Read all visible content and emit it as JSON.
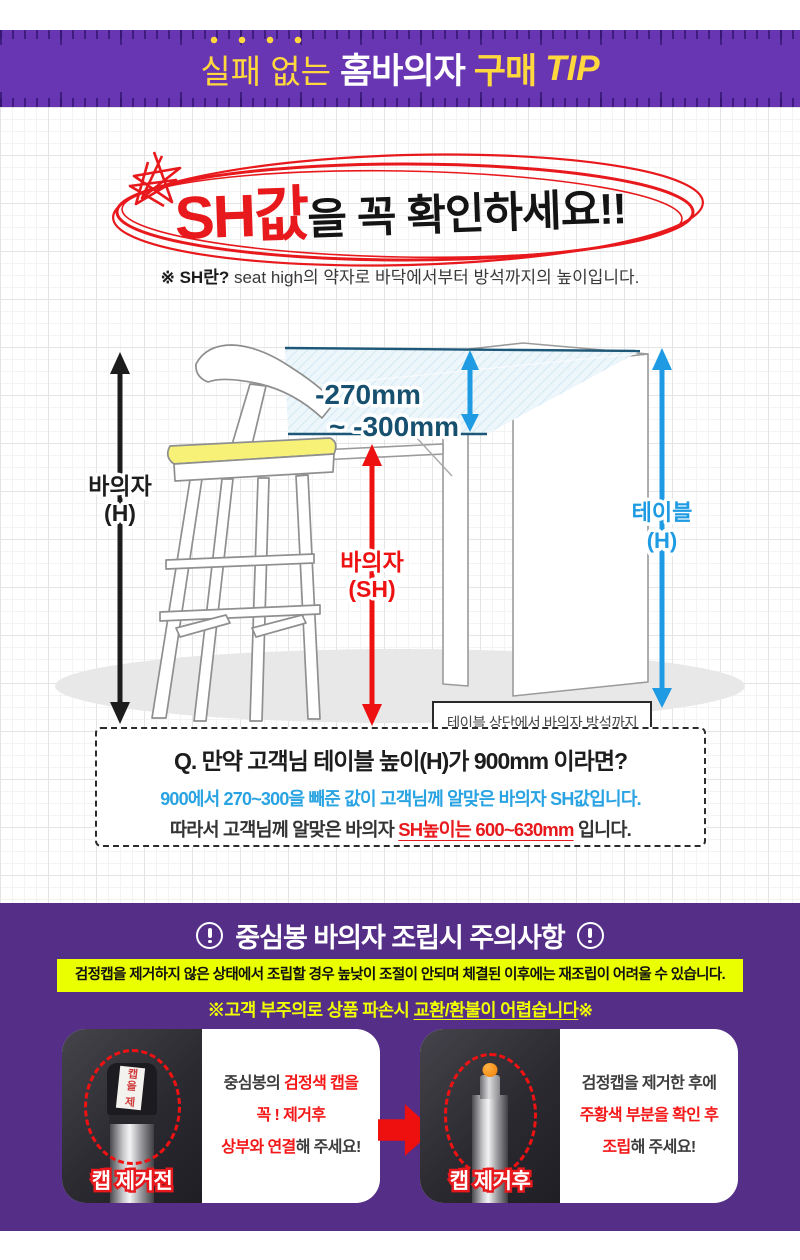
{
  "colors": {
    "purple_band": "#6836b3",
    "purple_section": "#552e87",
    "accent_red": "#e8191c",
    "accent_blue": "#29a0e2",
    "range_navy": "#17506f",
    "title_yellow": "#ffd83d",
    "highlight_yellow": "#eaff00",
    "cushion_yellow": "#f7f277"
  },
  "header": {
    "title": {
      "part1": "실패 없는",
      "part2": "홈바의자",
      "part3": "구매",
      "part4": "TIP"
    }
  },
  "hero": {
    "headline": {
      "highlight": "SH값",
      "rest": "을 꼭 확인하세요!!"
    },
    "definition": {
      "prefix": "※ SH란?",
      "rest": " seat high의 약자로 바닥에서부터 방석까지의 높이입니다."
    }
  },
  "diagram": {
    "range_line1": "-270mm",
    "range_line2": "~ -300mm",
    "chair_h": {
      "line1": "바의자",
      "line2": "(H)"
    },
    "chair_sh": {
      "line1": "바의자",
      "line2": "(SH)"
    },
    "table_h": {
      "line1": "테이블",
      "line2": "(H)"
    },
    "info_box": {
      "line1": "테이블 상단에서 바의자 방석까지",
      "line2_blue": "-270mm 부터 -300mm까지",
      "line2_tail": "가",
      "line3_underlined": "성인평균 사용 범위",
      "line3_tail": "입니다."
    }
  },
  "qa": {
    "question": "Q. 만약 고객님 테이블 높이(H)가 900mm 이라면?",
    "answer_line1": "900에서 270~300을 빼준 값이 고객님께 알맞은 바의자 SH값입니다.",
    "answer_line2_prefix": "따라서 고객님께 알맞은 바의자 ",
    "answer_line2_red": "SH높이는 600~630mm",
    "answer_line2_tail": " 입니다."
  },
  "caution": {
    "heading": "중심봉 바의자 조립시 주의사항",
    "highlight": "검정캡을 제거하지 않은 상태에서 조립할 경우 높낮이 조절이 안되며 체결된 이후에는 재조립이 어려울 수 있습니다.",
    "sub_prefix": "※고객 부주의로 상품 파손시 ",
    "sub_underlined": "교환/환불이 어렵습니다",
    "sub_tail": "※",
    "before": {
      "badge": "캡 제거전",
      "sticker": "캡을 제",
      "line1_dark": "중심봉의 ",
      "line1_red": "검정색 캡을",
      "line2_red": "꼭 ! 제거후",
      "line3_red": "상부와 연결",
      "line3_dark": "해 주세요!"
    },
    "after": {
      "badge": "캡 제거후",
      "line1_dark": "검정캡을 제거한 후에",
      "line2_red": "주황색 부분을 확인 후",
      "line3_red": "조립",
      "line3_dark": "해 주세요!"
    }
  }
}
